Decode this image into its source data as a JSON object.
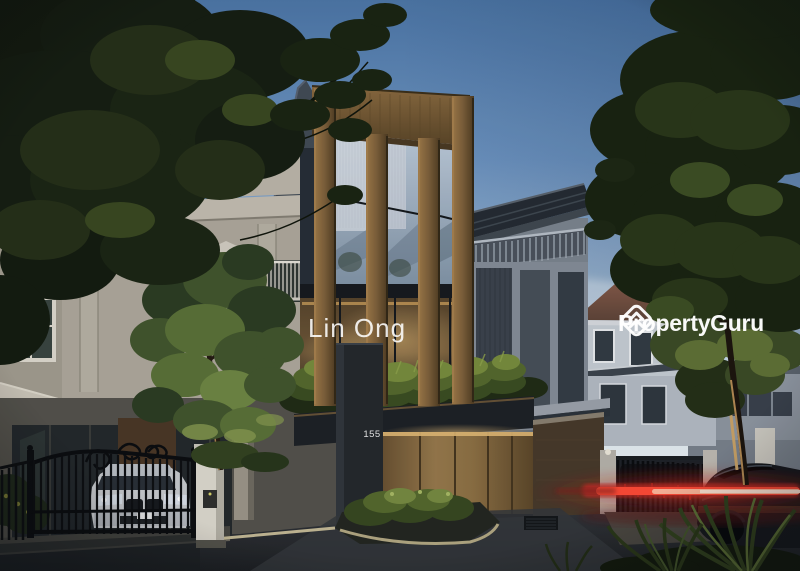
{
  "watermarks": {
    "agent_name": "Lin Ong",
    "brand": {
      "name": "PropertyGuru",
      "icon": "propertyguru-logo-icon",
      "color": "#ffffff"
    }
  },
  "property": {
    "house_number": "155"
  },
  "palette": {
    "sky_top": "#4c75a5",
    "sky_horizon": "#eff2f2",
    "cream_wall": "#aea79a",
    "gold_ornament": "#dcb83e",
    "wood_accent": "#8a6a3e",
    "charcoal": "#24272b",
    "grey_wall": "#7b838d",
    "brown_roof": "#7b5040",
    "foliage_dark": "#19220f",
    "planter_green": "#55682c",
    "tail_light_red": "#ff4934",
    "asphalt": "#27292c",
    "watermark_white": "#ffffff"
  }
}
